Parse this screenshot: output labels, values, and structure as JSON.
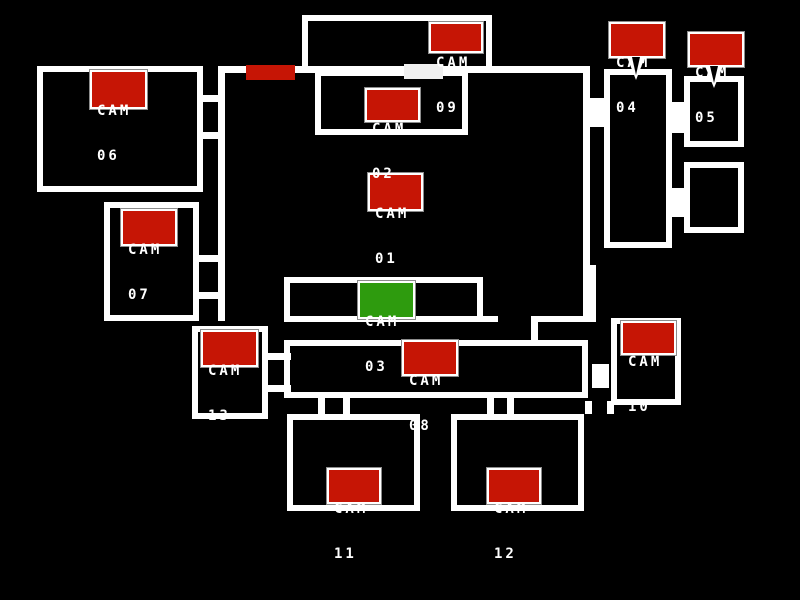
{
  "screen": "security-camera-map",
  "colors": {
    "background": "#000000",
    "walls": "#ffffff",
    "camera_button": "#c61505",
    "camera_button_selected": "#2e9b0e",
    "camera_text": "#ffffff",
    "button_outline": "#8c8c8c",
    "door_indicator_red": "#c61505",
    "door_indicator_white": "#f0f0f0"
  },
  "door_indicators": [
    {
      "name": "left-door-indicator",
      "color": "#c61505"
    },
    {
      "name": "right-door-indicator",
      "color": "#f0f0f0"
    }
  ],
  "cameras": [
    {
      "id": "cam-01",
      "label": "CAM",
      "number": "01",
      "selected": false
    },
    {
      "id": "cam-02",
      "label": "CAM",
      "number": "02",
      "selected": false
    },
    {
      "id": "cam-03",
      "label": "CAM",
      "number": "03",
      "selected": true
    },
    {
      "id": "cam-04",
      "label": "CAM",
      "number": "04",
      "selected": false
    },
    {
      "id": "cam-05",
      "label": "CAM",
      "number": "05",
      "selected": false
    },
    {
      "id": "cam-06",
      "label": "CAM",
      "number": "06",
      "selected": false
    },
    {
      "id": "cam-07",
      "label": "CAM",
      "number": "07",
      "selected": false
    },
    {
      "id": "cam-08",
      "label": "CAM",
      "number": "08",
      "selected": false
    },
    {
      "id": "cam-09",
      "label": "CAM",
      "number": "09",
      "selected": false
    },
    {
      "id": "cam-10",
      "label": "CAM",
      "number": "10",
      "selected": false
    },
    {
      "id": "cam-11",
      "label": "CAM",
      "number": "11",
      "selected": false
    },
    {
      "id": "cam-12",
      "label": "CAM",
      "number": "12",
      "selected": false
    },
    {
      "id": "cam-13",
      "label": "CAM",
      "number": "13",
      "selected": false
    }
  ]
}
